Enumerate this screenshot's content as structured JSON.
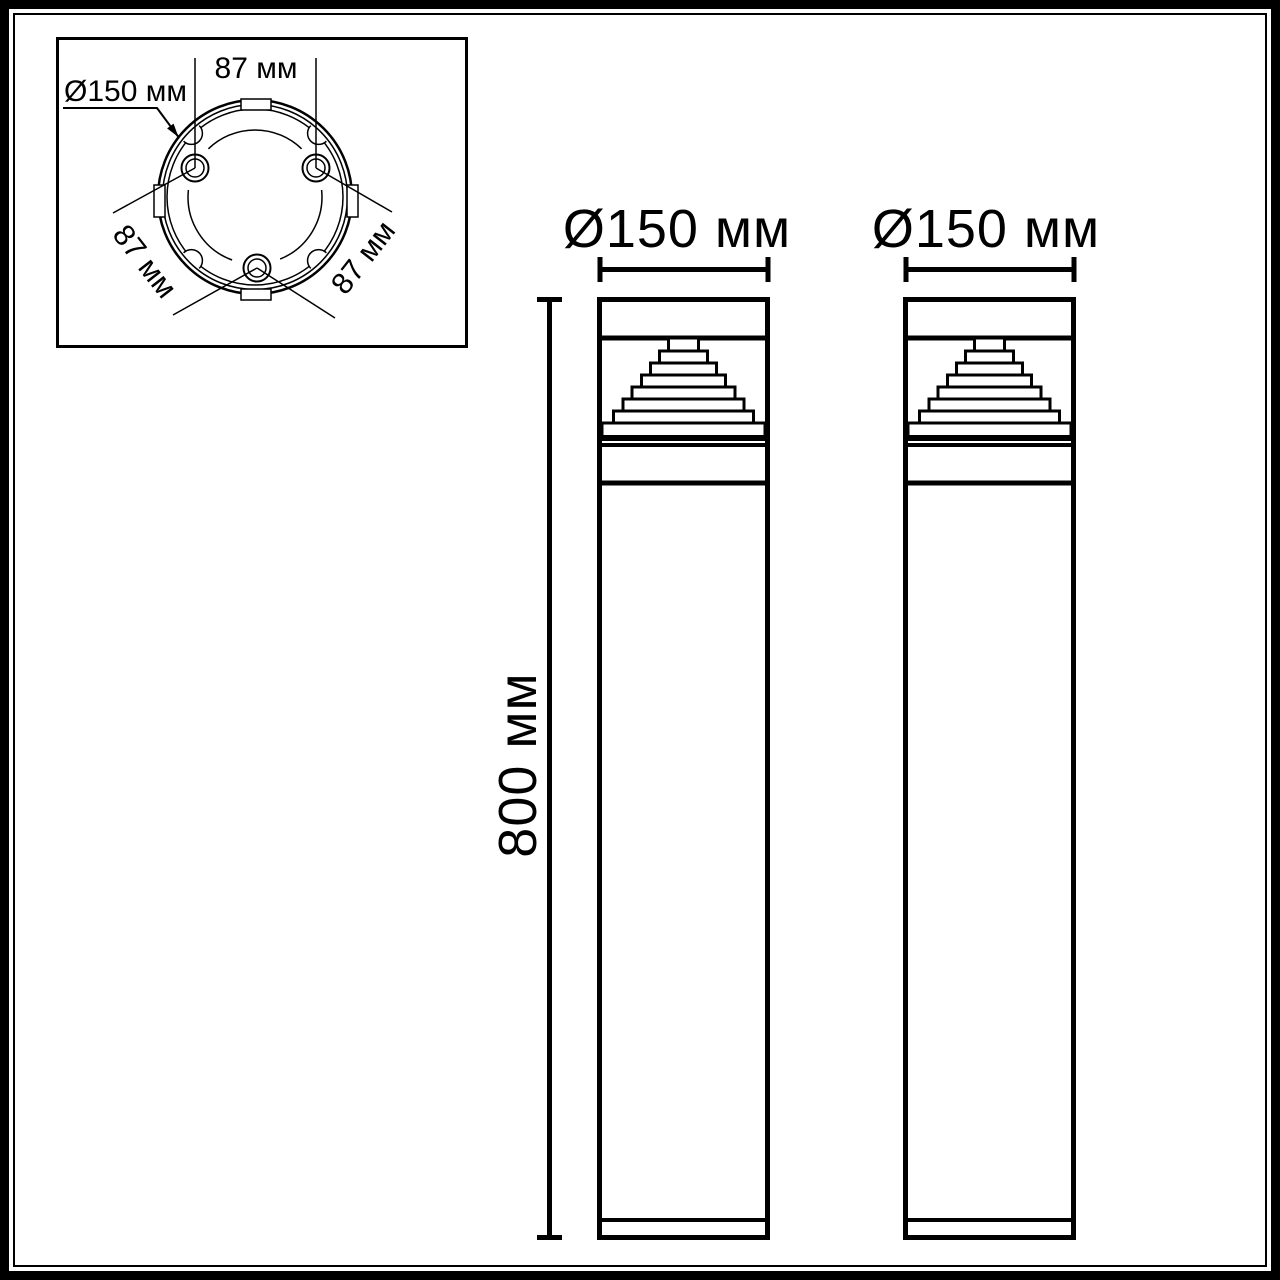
{
  "page": {
    "background": "#ffffff",
    "ink": "#000000"
  },
  "inset_top_view": {
    "hole_spacing_top": "87 мм",
    "plate_diameter": "Ø150 мм",
    "hole_spacing_left": "87 мм",
    "hole_spacing_right": "87 мм"
  },
  "front_views": {
    "left_diameter": "Ø150 мм",
    "right_diameter": "Ø150 мм",
    "height": "800 мм"
  }
}
